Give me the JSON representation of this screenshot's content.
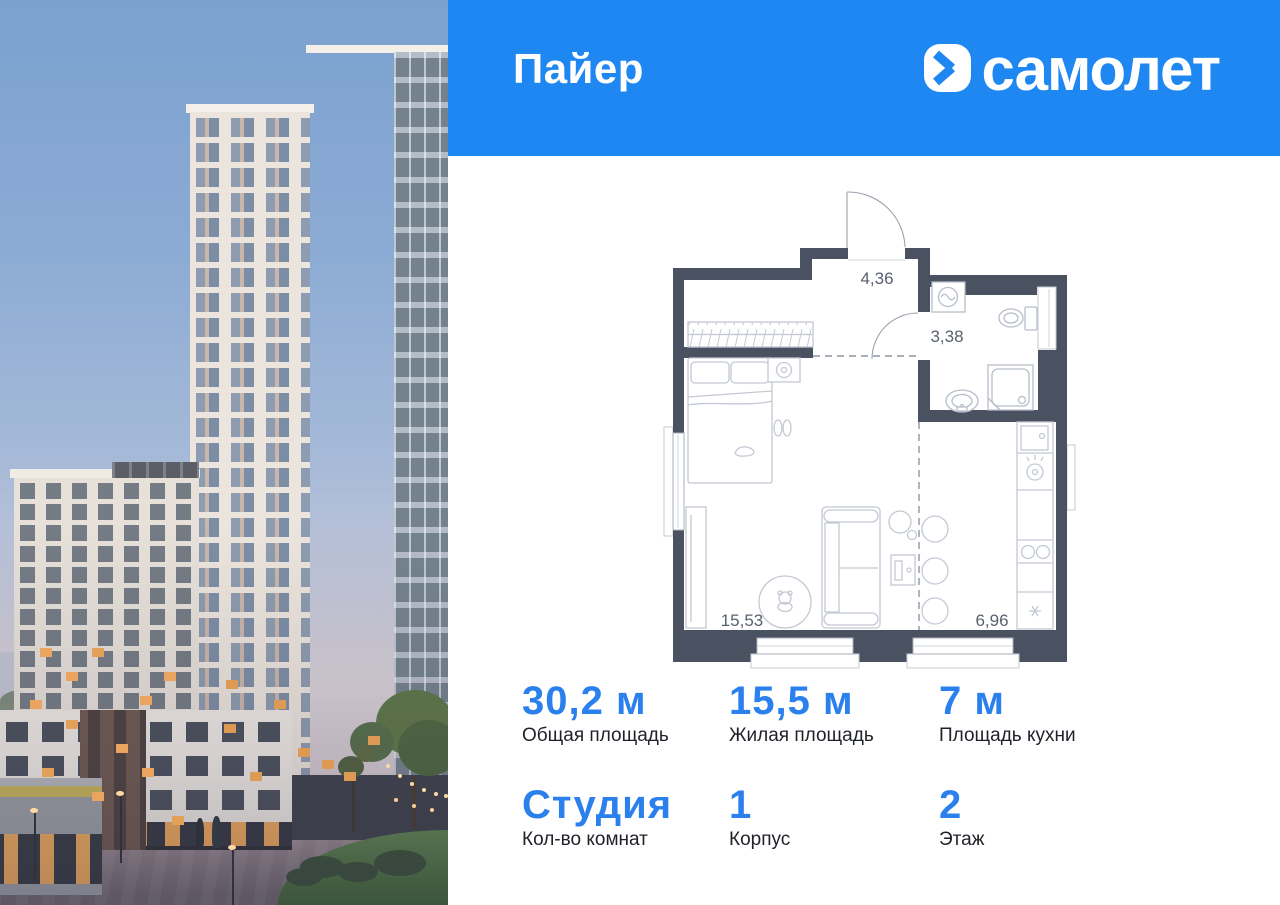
{
  "header": {
    "project_title": "Пайер",
    "brand_name": "самолет",
    "logo_icon": "samolet-logo-icon"
  },
  "floor_plan": {
    "areas": {
      "hallway": "4,36",
      "bathroom": "3,38",
      "living_room": "15,53",
      "kitchen": "6,96"
    }
  },
  "stats": {
    "cards": [
      {
        "value": "30,2 м",
        "label": "Общая площадь"
      },
      {
        "value": "15,5 м",
        "label": "Жилая площадь"
      },
      {
        "value": "7 м",
        "label": "Площадь кухни"
      },
      {
        "value": "Студия",
        "label": "Кол-во комнат"
      },
      {
        "value": "1",
        "label": "Корпус"
      },
      {
        "value": "2",
        "label": "Этаж"
      }
    ]
  },
  "colors": {
    "header_bg": "#1F87F2",
    "accent": "#2A80EC",
    "plan_walls": "#4A5160"
  }
}
